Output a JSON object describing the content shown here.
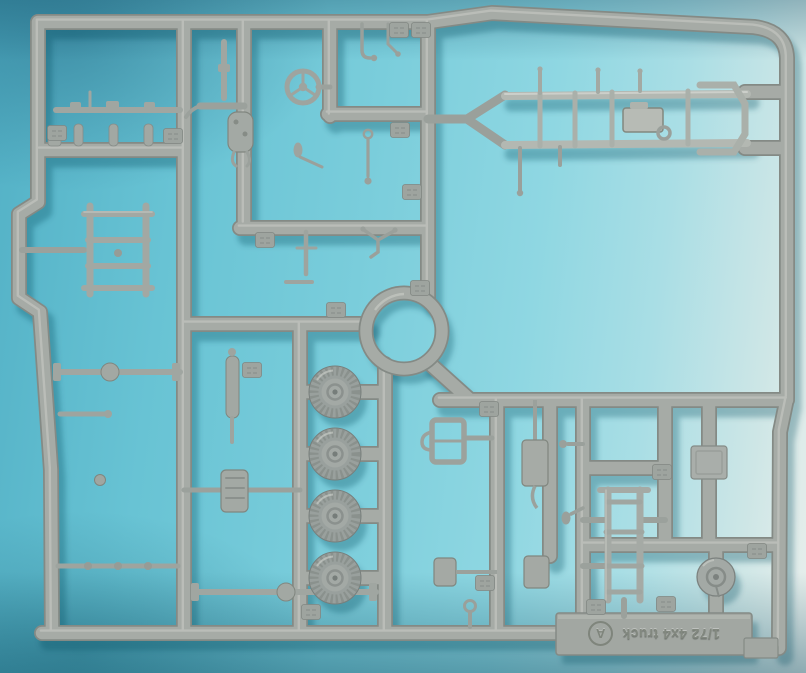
{
  "photo": {
    "scene": "plastic-model-kit-sprue",
    "colors": {
      "backdrop_cyan": "#68c3d4",
      "backdrop_pale_wall": "#e9efec",
      "backdrop_shadow_teal": "#1d6f8d",
      "plastic_gray": "#a6aba6",
      "plastic_edge": "#848a85",
      "plastic_highlight": "#cdd0ca"
    }
  },
  "sprue": {
    "letter": "A",
    "marking": "1/72 4x4 truck",
    "parts": [
      "chassis-ladder-frame",
      "steering-wheel",
      "road-wheel",
      "road-wheel",
      "road-wheel",
      "road-wheel",
      "roof-rack-frame",
      "drive-shaft",
      "front-axle",
      "rear-axle",
      "leaf-spring",
      "transfer-case",
      "exhaust-pipe",
      "radiator",
      "fuel-tank",
      "truck-bed-frame",
      "mounting-plate",
      "brake-drum",
      "gear-lever",
      "rear-view-mirror",
      "tow-hook",
      "part-number-tabs"
    ]
  }
}
